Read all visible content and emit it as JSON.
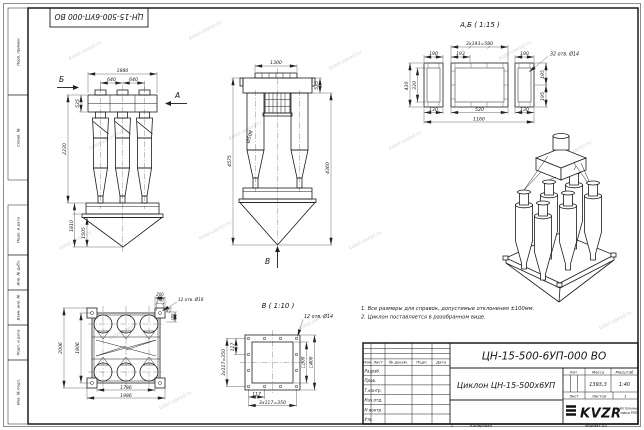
{
  "frame": {
    "stamp": "ЦН-15-500-6УП-000 ВО",
    "margin_boxes": [
      "Перв. примен.",
      "Справ. №",
      "Подп. и дата",
      "Инв. № дубл.",
      "Взам. инв. №",
      "Подп. и дата",
      "Инв. № подл."
    ],
    "bottom": {
      "num": "1",
      "copy": "Копировал",
      "format": "Формат А3"
    }
  },
  "watermark": "kotel-zavod.ru",
  "notes": [
    "1. Все размеры для справок, допустимые отклонения ±100мм.",
    "2. Циклон поставляется в разобранном виде."
  ],
  "title_block": {
    "doc_number": "ЦН-15-500-6УП-000 ВО",
    "product_name": "Циклон ЦН-15-500х6УП",
    "cols": {
      "izm": "Изм",
      "list": "Лист",
      "doc": "№ докум.",
      "podp": "Подп.",
      "data": "Дата"
    },
    "rows": [
      "Разраб.",
      "Пров.",
      "Т.контр.",
      "Нач.отд.",
      "Н.контр.",
      "Утв."
    ],
    "lit": "Лит.",
    "mass": "Масса",
    "scale": "Масштаб",
    "mass_value": "1393,3",
    "scale_value": "1:40",
    "sheet": "Лист",
    "sheets": "Листов",
    "sheets_value": "1",
    "logo": "KVZR",
    "company_line1": "Котельный",
    "company_line2": "завод РЭП"
  },
  "views": {
    "front": {
      "arrow_b": "Б",
      "arrow_a": "А",
      "dim_1880": "1880",
      "dim_640a": "640",
      "dim_640b": "640",
      "dim_535": "535",
      "dim_2230": "2230",
      "dim_1810": "1810",
      "dim_1505": "1505"
    },
    "side": {
      "arrow_v": "В",
      "dim_1300": "1300",
      "dim_535": "535",
      "dim_d508": "Ø508",
      "dim_4575": "4575",
      "dim_4360": "4360"
    },
    "flange_ab": {
      "title": "А,Б ( 1:15 )",
      "dim_pitch": "3x193=580",
      "dim_190a": "190",
      "dim_193": "193",
      "dim_190b": "190",
      "holes": "32 отв. Ø14",
      "dim_430": "430",
      "dim_330": "330",
      "dim_195a": "195",
      "dim_195b": "195",
      "dim_130a": "130",
      "dim_520": "520",
      "dim_130b": "130",
      "dim_1160": "1160"
    },
    "plan": {
      "dim_200": "200",
      "dim_140": "140",
      "holes": "12 отв. Ø18",
      "dim_40": "40",
      "dim_200b": "200",
      "dim_2006": "2006",
      "dim_1806": "1806",
      "dim_1786": "1786",
      "dim_1986": "1986"
    },
    "flange_v": {
      "title": "В ( 1:10 )",
      "holes": "12 отв. Ø14",
      "dim_117l": "117",
      "dim_pitch_l": "3x117=350",
      "dim_sq300": "□300",
      "dim_sq400": "□400",
      "dim_117b": "117",
      "dim_pitch_b": "3x117=350"
    }
  }
}
